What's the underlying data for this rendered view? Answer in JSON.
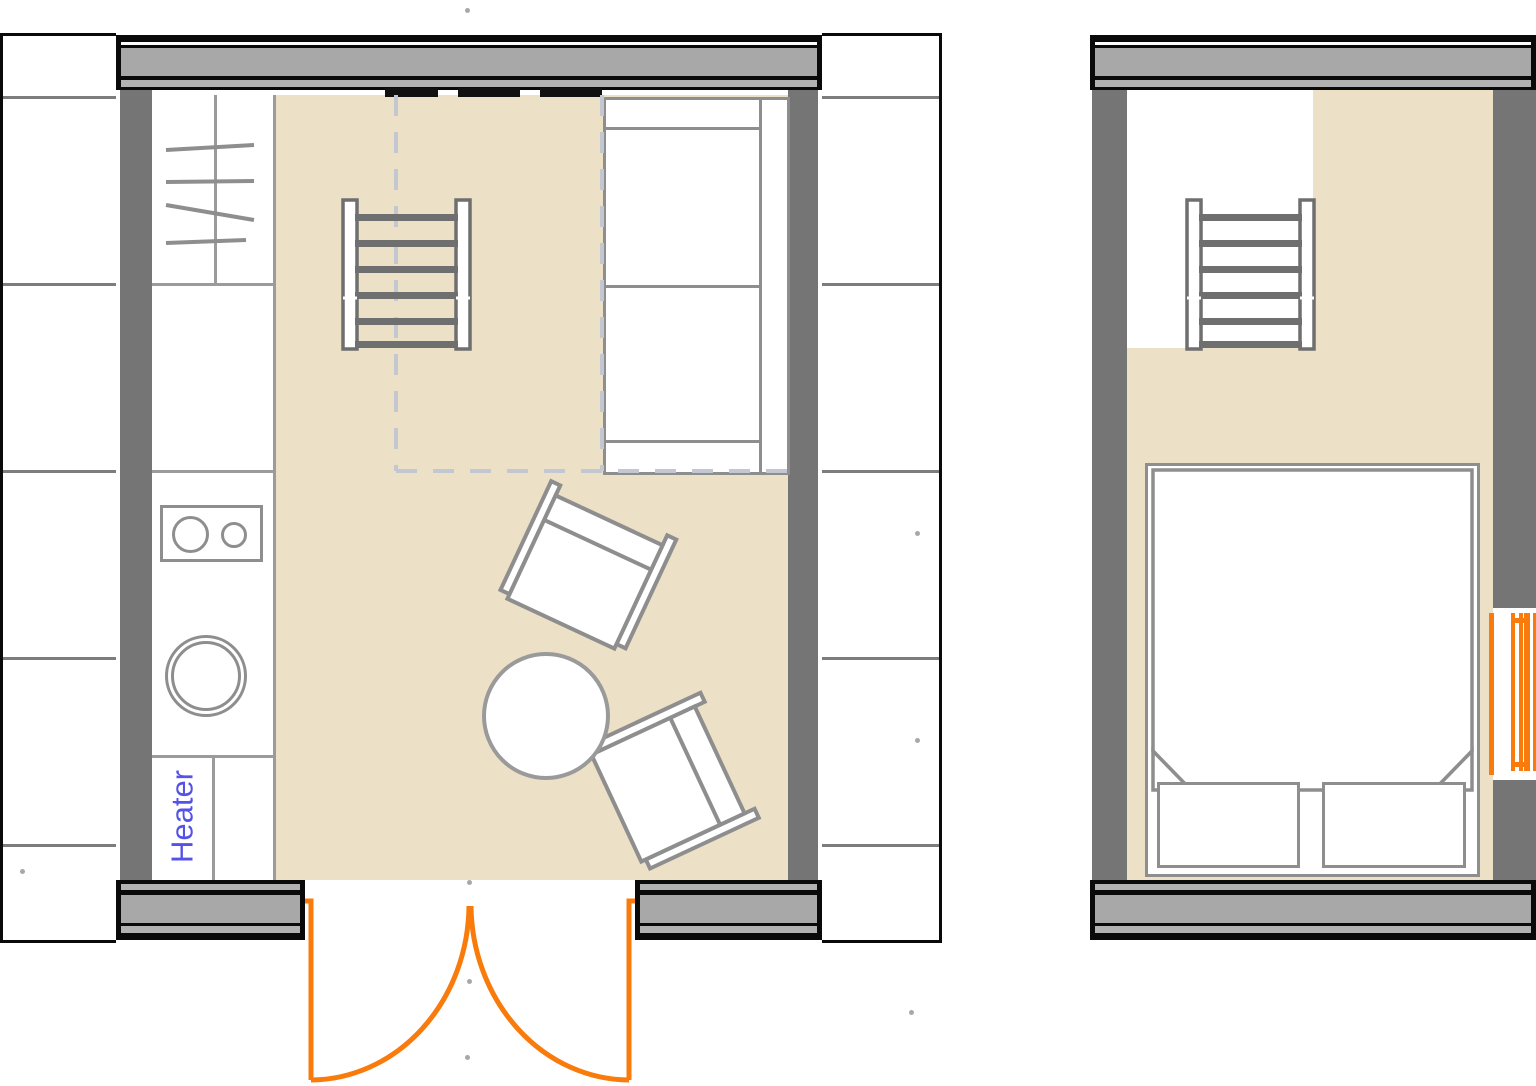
{
  "document": {
    "type": "floor-plan",
    "views": 2
  },
  "labels": {
    "heater": "Heater"
  },
  "colors": {
    "floor": "#ece0c7",
    "wall-side": "#757575",
    "wall-fill": "#a8a8a8",
    "wall-mid": "#b2b2b2",
    "wall-line": "#0a0a0a",
    "outline": "#8e8e8e",
    "table-outline": "#9a9a9a",
    "stair": "#6f6f6f",
    "grid-line": "#7d7d7d",
    "dash": "#c3c7d2",
    "orange": "#f87b0c",
    "blue": "#5452e8",
    "dot": "#999999"
  },
  "rooms": {
    "left_room": {
      "items": [
        "kitchen-rack",
        "stove",
        "sink",
        "heater",
        "stairs",
        "loft-dashed-outline",
        "sofa",
        "armchair",
        "armchair",
        "round-table",
        "entry-double-door"
      ]
    },
    "right_room": {
      "items": [
        "stairs",
        "double-bed",
        "pillow",
        "pillow",
        "radiator-window"
      ]
    }
  }
}
